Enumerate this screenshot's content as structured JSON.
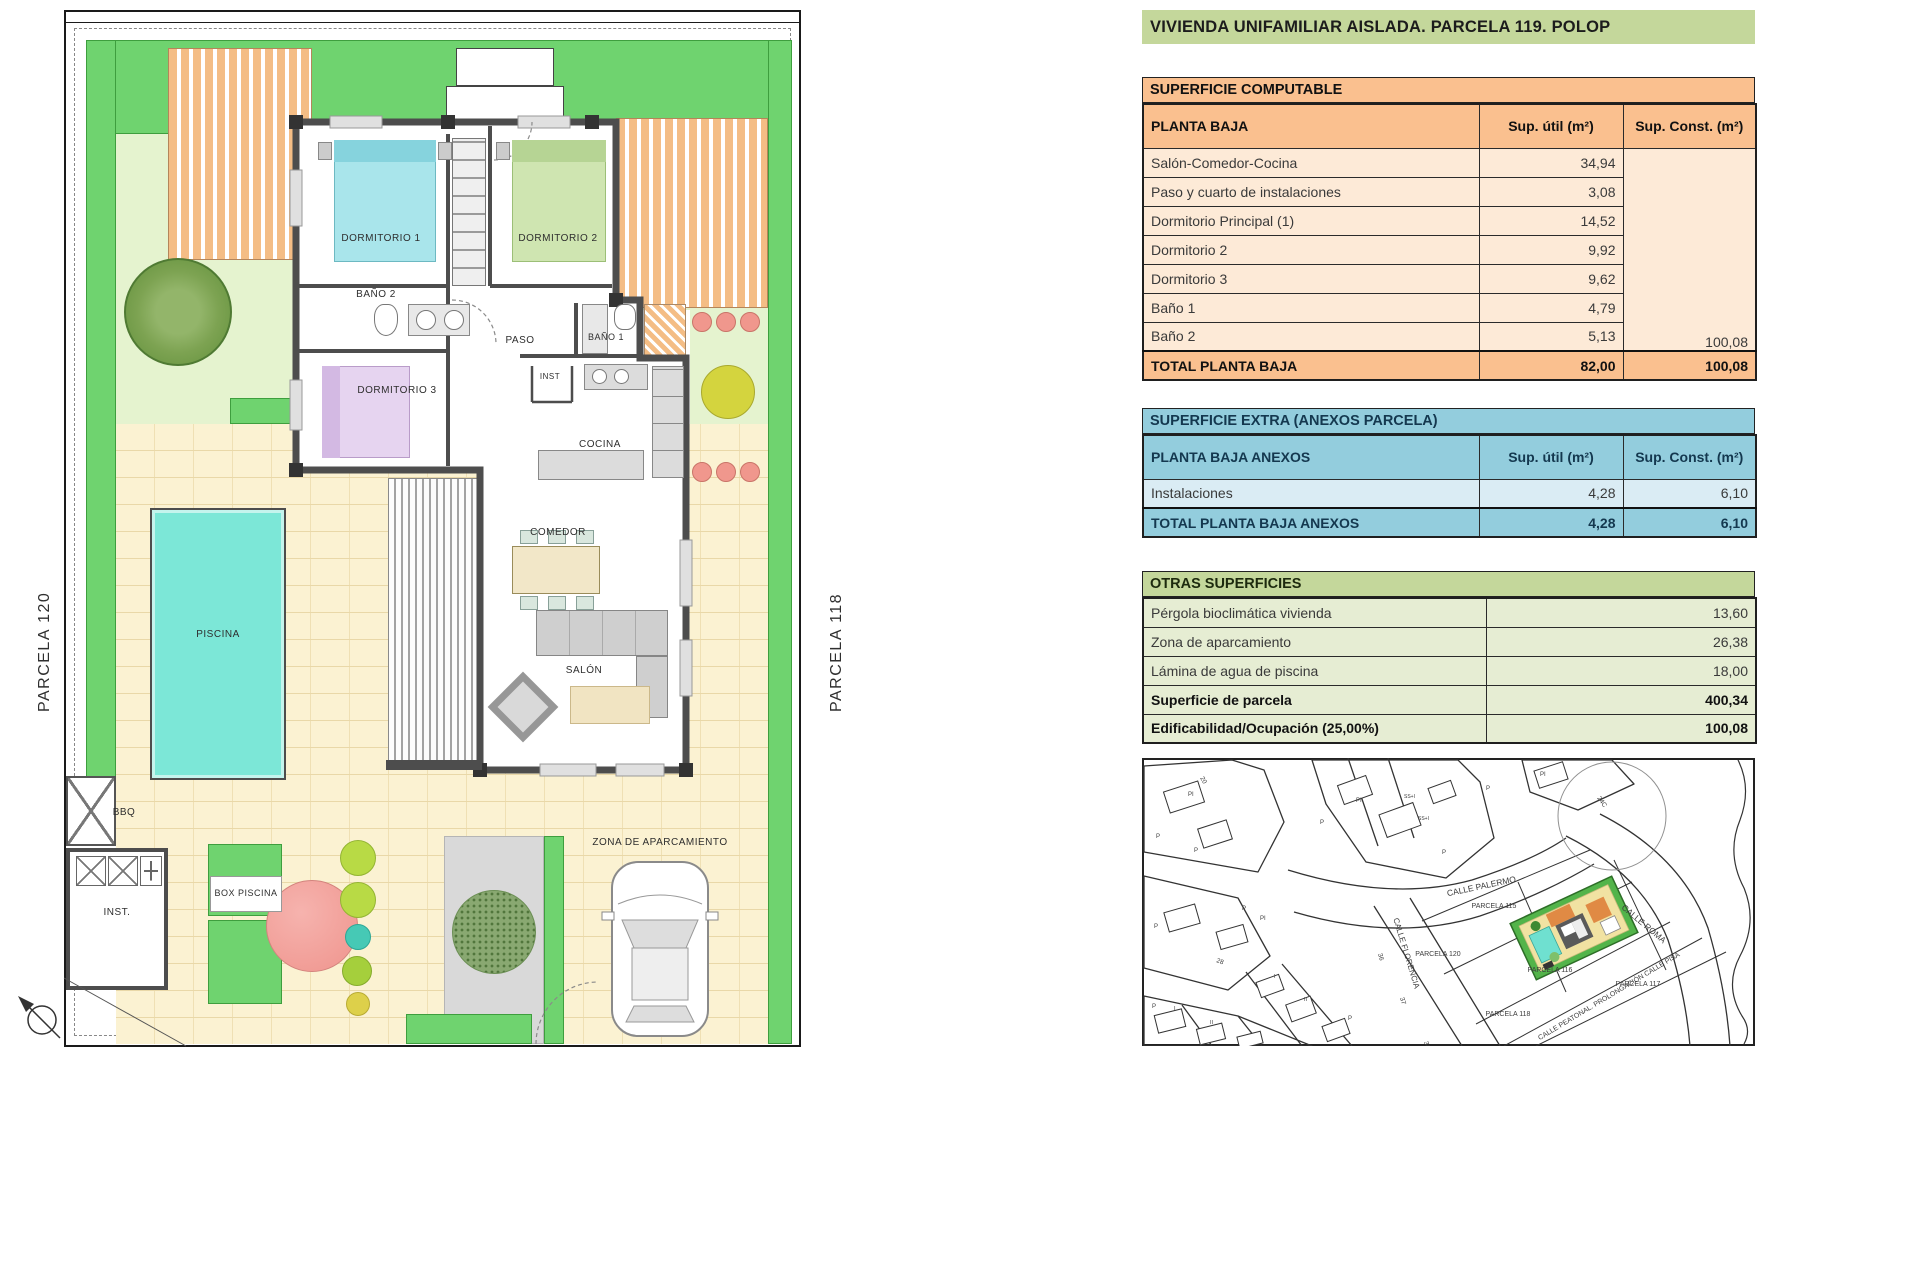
{
  "title": "VIVIENDA UNIFAMILIAR AISLADA. PARCELA 119. POLOP",
  "tables": {
    "computable": {
      "section_title": "SUPERFICIE COMPUTABLE",
      "header": {
        "col1": "PLANTA BAJA",
        "col2": "Sup. útil (m²)",
        "col3": "Sup. Const. (m²)"
      },
      "rows": [
        {
          "label": "Salón-Comedor-Cocina",
          "util": "34,94",
          "const": ""
        },
        {
          "label": "Paso y cuarto de instalaciones",
          "util": "3,08",
          "const": ""
        },
        {
          "label": "Dormitorio Principal (1)",
          "util": "14,52",
          "const": ""
        },
        {
          "label": "Dormitorio 2",
          "util": "9,92",
          "const": ""
        },
        {
          "label": "Dormitorio 3",
          "util": "9,62",
          "const": ""
        },
        {
          "label": "Baño 1",
          "util": "4,79",
          "const": ""
        },
        {
          "label": "Baño 2",
          "util": "5,13",
          "const": "100,08"
        }
      ],
      "total": {
        "label": "TOTAL PLANTA BAJA",
        "util": "82,00",
        "const": "100,08"
      }
    },
    "extra": {
      "section_title": "SUPERFICIE EXTRA (ANEXOS PARCELA)",
      "header": {
        "col1": "PLANTA BAJA ANEXOS",
        "col2": "Sup. útil (m²)",
        "col3": "Sup. Const. (m²)"
      },
      "rows": [
        {
          "label": "Instalaciones",
          "util": "4,28",
          "const": "6,10"
        }
      ],
      "total": {
        "label": "TOTAL PLANTA BAJA ANEXOS",
        "util": "4,28",
        "const": "6,10"
      }
    },
    "otras": {
      "section_title": "OTRAS SUPERFICIES",
      "rows": [
        {
          "label": "Pérgola bioclimática vivienda",
          "value": "13,60"
        },
        {
          "label": "Zona de aparcamiento",
          "value": "26,38"
        },
        {
          "label": "Lámina de agua de piscina",
          "value": "18,00"
        },
        {
          "label": "Superficie de parcela",
          "value": "400,34"
        },
        {
          "label": "Edificabilidad/Ocupación (25,00%)",
          "value": "100,08"
        }
      ]
    }
  },
  "plan": {
    "labels": {
      "dormitorio1": "DORMITORIO 1",
      "dormitorio2": "DORMITORIO 2",
      "dormitorio3": "DORMITORIO 3",
      "bano1": "BAÑO 1",
      "bano2": "BAÑO 2",
      "paso": "PASO",
      "inst": "INST",
      "cocina": "COCINA",
      "comedor": "COMEDOR",
      "salon": "SALÓN",
      "piscina": "PISCINA",
      "bbq": "BBQ",
      "inst_exterior": "INST.",
      "box_piscina": "BOX PISCINA",
      "zona_aparcamiento": "ZONA DE APARCAMIENTO",
      "parcela_left": "PARCELA 120",
      "parcela_right": "PARCELA 118"
    }
  },
  "map": {
    "palermo": "CALLE PALERMO",
    "roma": "CALLE ROMA",
    "florencia": "CALLE FLORENCIA",
    "peatonal": "CALLE PEATONAL. PROLONGACIÓN CALLE PISA",
    "p115": "PARCELA 115",
    "p120": "PARCELA 120",
    "p116": "PARCELA 116",
    "p117": "PARCELA 117",
    "p118": "PARCELA 118",
    "n20": "20",
    "n28": "28",
    "n36": "36",
    "n37": "37",
    "n38": "38",
    "n24c": "24C",
    "lbl_p": "P",
    "lbl_pi": "PI",
    "lbl_ssi": "SS+I",
    "lbl_i": "I",
    "lbl_ii": "II"
  },
  "colors": {
    "hedge": "#6fd36f",
    "lawn": "#e5f3cf",
    "paving": "#fbf2d2",
    "pool": "#7ce7d7",
    "pergola": "#f4bd85",
    "wall": "#4d4d4d",
    "orange_header": "#fac08f",
    "orange_row": "#fdead7",
    "blue_header": "#93cddd",
    "blue_row": "#daecf4",
    "green_header": "#c4d79b",
    "green_row": "#e6edd3"
  }
}
